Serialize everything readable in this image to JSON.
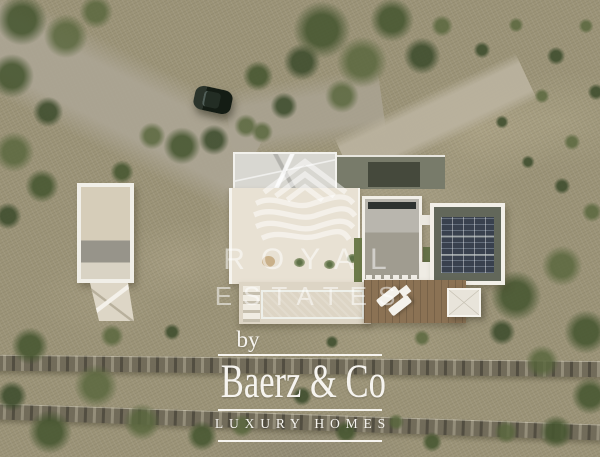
{
  "watermark_center": {
    "logo_icon": "royal-estates-logo",
    "line1": "ROYAL",
    "line2": "ESTATES",
    "color": "#ffffff",
    "opacity": 0.5
  },
  "watermark_bottom": {
    "prefix": "by",
    "brand": "Baerz & Co",
    "tagline": "LUXURY HOMES",
    "color": "#f6f4ef"
  },
  "scene": {
    "description": "Aerial top-down drone view of a modern white villa with turquoise swimming pool, rooftop solar panels, wooden sun deck with loungers, detached carport pergola, concrete driveway joining a dirt road with a parked dark car, olive trees, dry scrubland and two dry-stone terrace walls",
    "colors": {
      "terrain": "#9c9478",
      "trees": "#55663c",
      "dirt_road": "#aca590",
      "villa_white": "#e8e1d3",
      "pool_water": "#55c2bd",
      "solar_panels": "#39414e",
      "deck_wood": "#8b7254",
      "stone_wall": "#6f6958",
      "car": "#1f2a1f"
    }
  }
}
